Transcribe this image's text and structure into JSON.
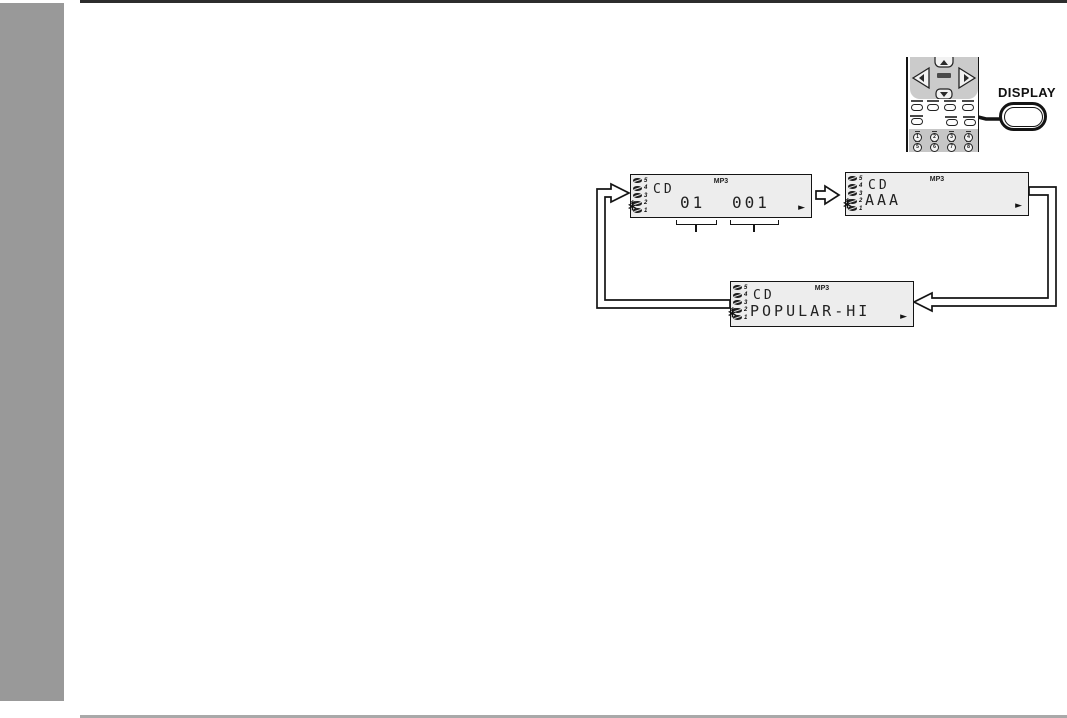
{
  "page": {
    "background": "#ffffff",
    "sidebar_color": "#999999",
    "top_rule_color": "#2d2d2d",
    "bottom_rule_color": "#a9a9a9"
  },
  "remote": {
    "callout_button_label": "DISPLAY",
    "keypad_digits": [
      "1",
      "2",
      "3",
      "4",
      "5",
      "6",
      "7",
      "8"
    ]
  },
  "icons": {
    "play": "►",
    "blink_rays": "*"
  },
  "lcd": {
    "disc_numbers": [
      "5",
      "4",
      "3",
      "2",
      "1"
    ],
    "displays": [
      {
        "mp3": "MP3",
        "source": "CD",
        "album_number": "01",
        "track_number": "001"
      },
      {
        "mp3": "MP3",
        "source": "CD",
        "text": "AAA"
      },
      {
        "mp3": "MP3",
        "source": "CD",
        "text": "POPULAR-HI"
      }
    ]
  }
}
